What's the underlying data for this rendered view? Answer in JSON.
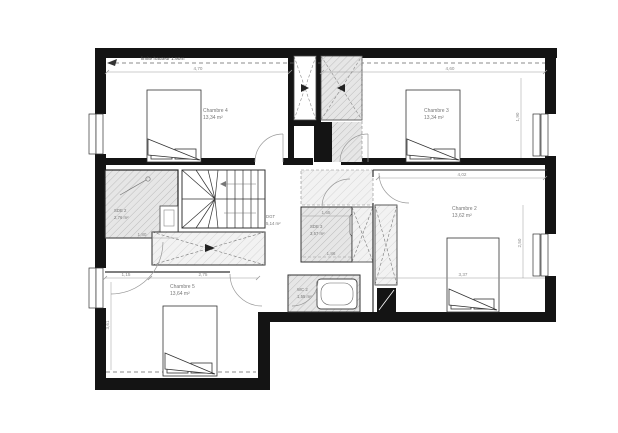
{
  "drawing": {
    "type": "architectural-floor-plan",
    "annotation": {
      "height_limit": "limite hauteur 1.90m"
    }
  },
  "rooms": {
    "chambre4": {
      "name": "Chambre 4",
      "area": "13,34 m²"
    },
    "chambre3": {
      "name": "Chambre 3",
      "area": "13,34 m²"
    },
    "chambre2": {
      "name": "Chambre 2",
      "area": "13,62 m²"
    },
    "chambre5": {
      "name": "Chambre 5",
      "area": "13,64 m²"
    },
    "sde2": {
      "name": "SDE 2",
      "area": "2,76 m²"
    },
    "sde3": {
      "name": "SDE 3",
      "area": "3,57 m²"
    },
    "dgt": {
      "name": "DGT",
      "area": "5,14 m²"
    },
    "wc2": {
      "name": "WC 2",
      "area": "1,55 m²"
    }
  },
  "dims": {
    "top_left": "4,70",
    "top_right": "4,60",
    "ch2_top": "4,02",
    "ch2_width": "3,37",
    "ch5_a": "1,15",
    "ch5_b": "2,75",
    "sde2_width": "1,80",
    "sde3_width": "1,65",
    "sde3_depth": "1,86",
    "ch2_right": "2,50",
    "ch3_right": "1,90",
    "ch5_left": "3,61"
  },
  "colors": {
    "wall": "#141414",
    "hatch_fill": "#e4e4e4",
    "hatch_line": "#b8b8b8",
    "thin_line": "#444444",
    "dim_line": "#999999",
    "text": "#777777"
  }
}
